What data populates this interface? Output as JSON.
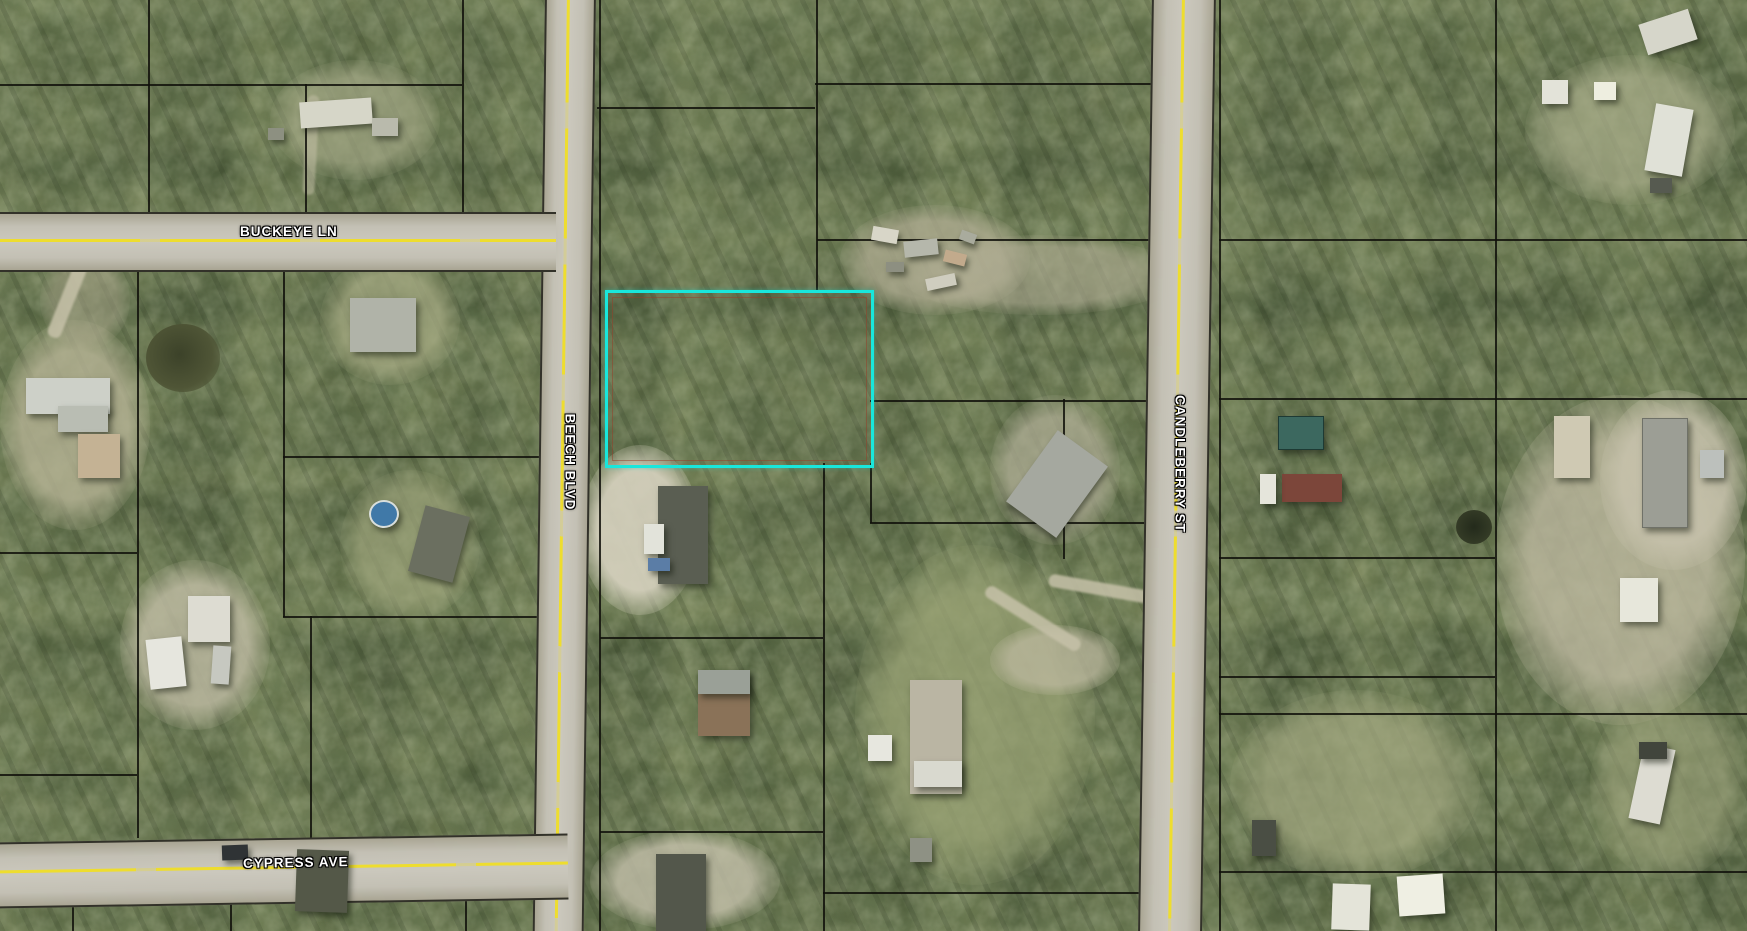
{
  "map": {
    "type": "aerial-parcel-map",
    "roads": [
      {
        "name": "BUCKEYE LN",
        "orientation": "horizontal"
      },
      {
        "name": "CYPRESS AVE",
        "orientation": "horizontal"
      },
      {
        "name": "BEECH BLVD",
        "orientation": "vertical"
      },
      {
        "name": "CANDLEBERRY ST",
        "orientation": "vertical"
      }
    ],
    "highlight_parcel": {
      "description": "selected vacant wooded parcel outlined in cyan",
      "outline_color": "#19E7DC"
    },
    "style": {
      "parcel_line_color": "#141410",
      "road_centerline_color": "#EEDD2E",
      "label_text_color": "#FFFFFF"
    }
  }
}
